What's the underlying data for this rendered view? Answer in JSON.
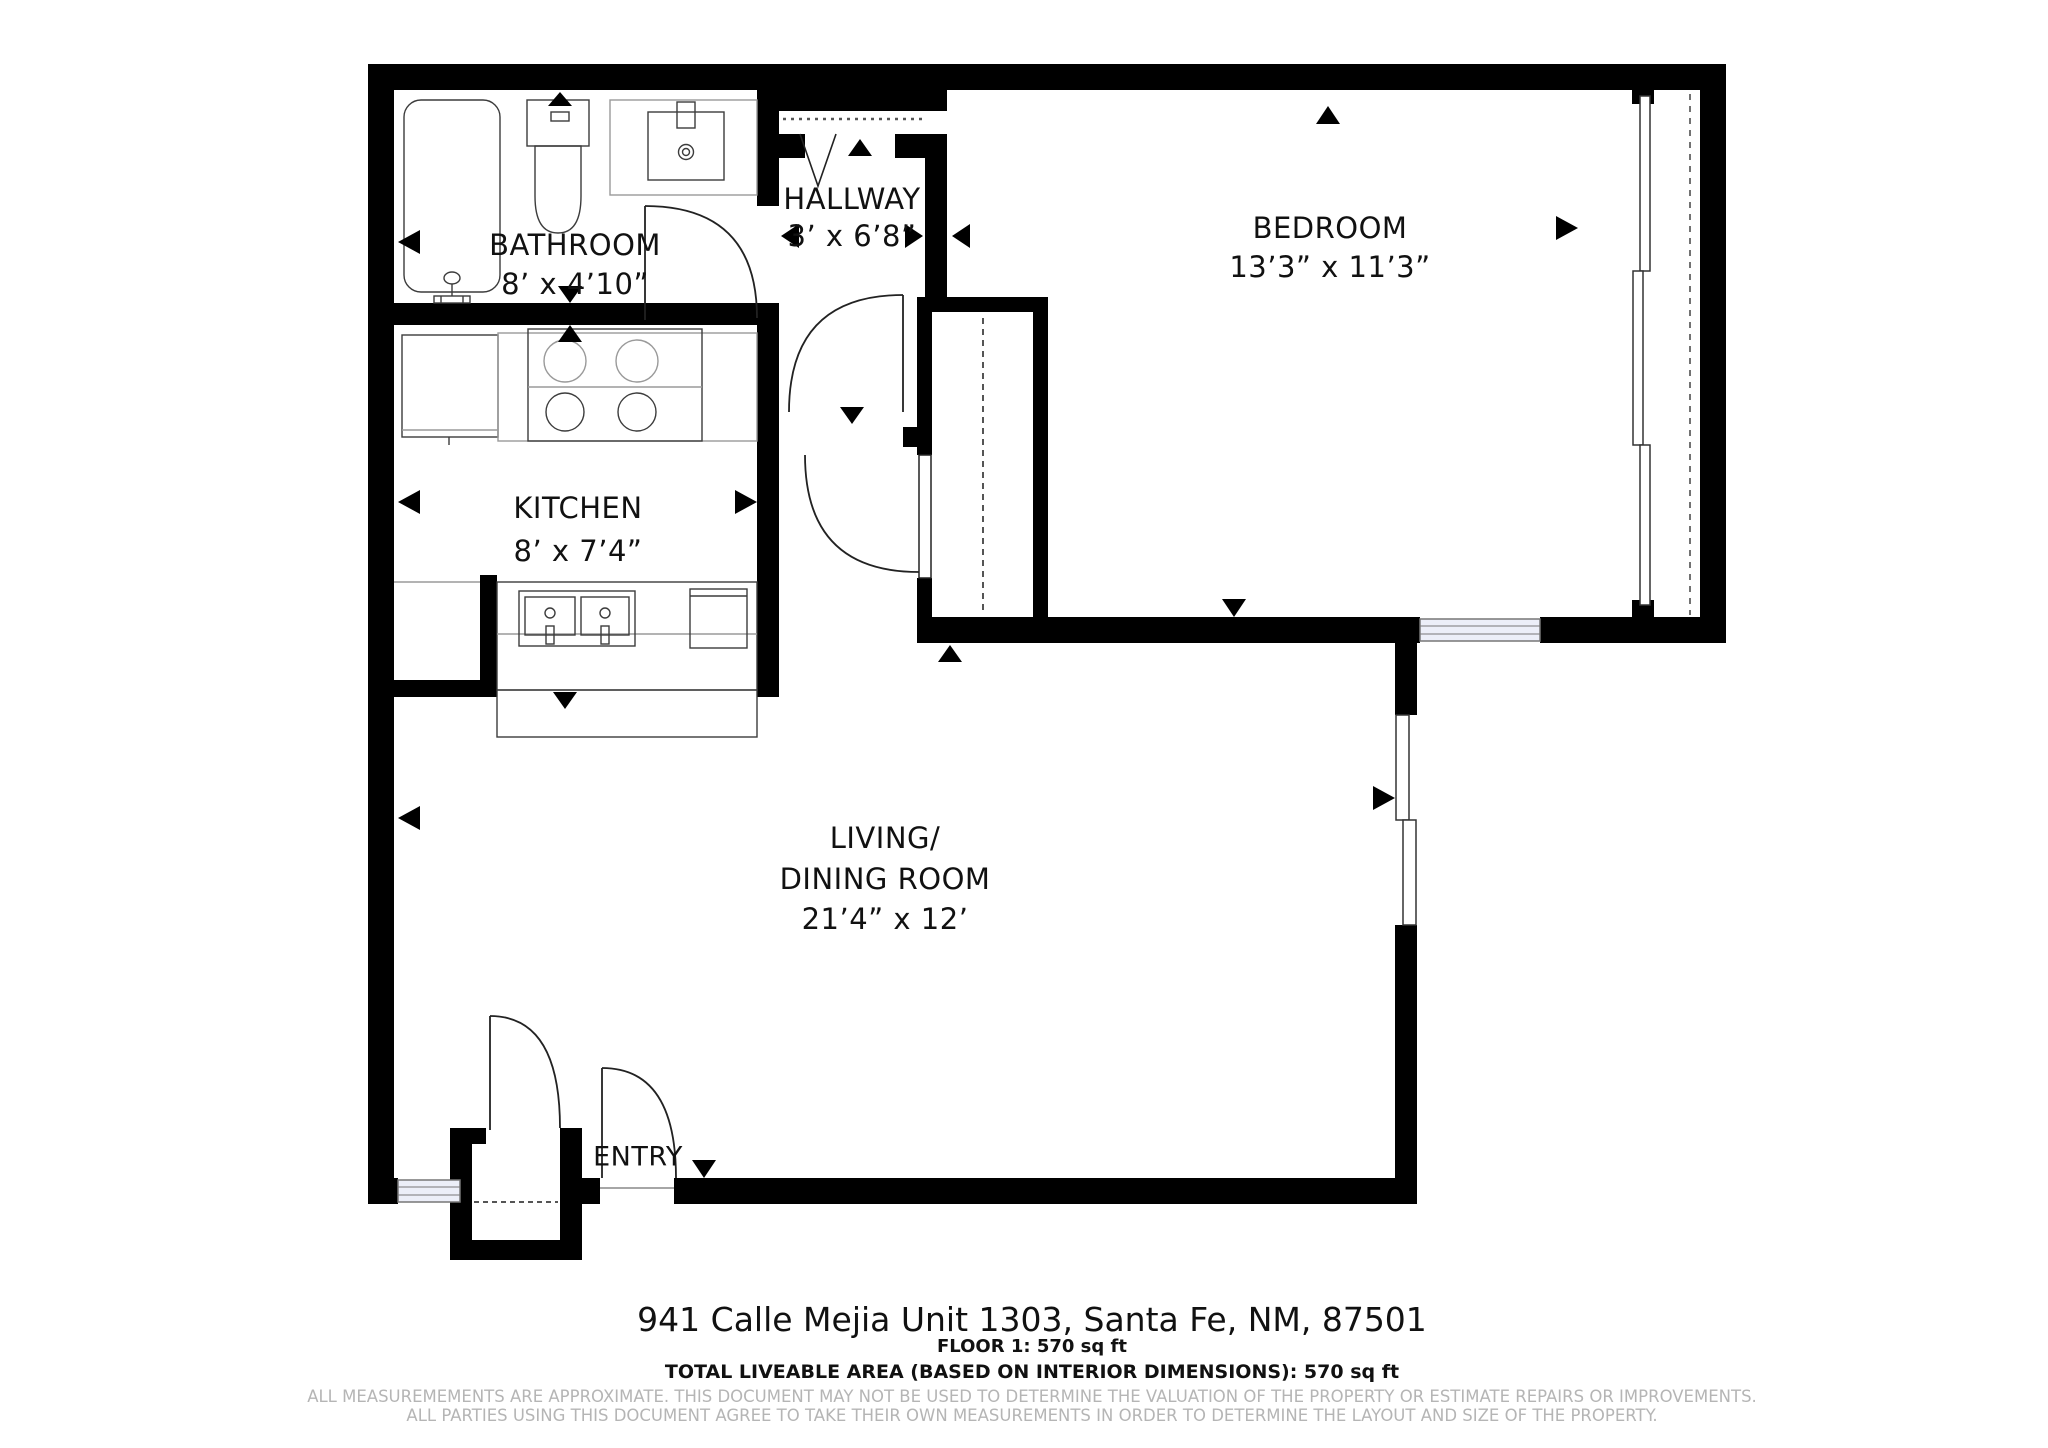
{
  "plan": {
    "rooms": {
      "bathroom": {
        "name": "BATHROOM",
        "dims": "8’ x 4’10”"
      },
      "hallway": {
        "name": "HALLWAY",
        "dims": "3’ x 6’8”"
      },
      "bedroom": {
        "name": "BEDROOM",
        "dims": "13’3” x 11’3”"
      },
      "kitchen": {
        "name": "KITCHEN",
        "dims": "8’ x 7’4”"
      },
      "living": {
        "line1": "LIVING/",
        "line2": "DINING ROOM",
        "dims": "21’4” x 12’"
      },
      "entry": {
        "name": "ENTRY"
      }
    },
    "fixtures": [
      "bathtub",
      "toilet",
      "vanity-sink",
      "refrigerator",
      "stove-4-burner",
      "double-kitchen-sink",
      "dishwasher",
      "counter-bar"
    ],
    "colors": {
      "wall": "#000000",
      "window_fill": "#eceef8",
      "fixture_stroke": "#3c3c3c",
      "light_stroke": "#9a9a9a",
      "dash": "#555555",
      "disclaimer_text": "#b5b5b5"
    }
  },
  "footer": {
    "address": "941 Calle Mejia Unit 1303, Santa Fe, NM, 87501",
    "floor_area": "FLOOR 1: 570 sq ft",
    "total_area": "TOTAL LIVEABLE AREA (BASED ON INTERIOR DIMENSIONS): 570 sq ft",
    "disclaimer_line1": "ALL MEASUREMEMENTS ARE APPROXIMATE. THIS DOCUMENT MAY NOT BE USED TO DETERMINE THE VALUATION OF THE PROPERTY OR ESTIMATE REPAIRS OR IMPROVEMENTS.",
    "disclaimer_line2": "ALL PARTIES USING THIS DOCUMENT AGREE TO TAKE THEIR OWN MEASUREMENTS IN ORDER TO DETERMINE THE LAYOUT AND SIZE OF THE PROPERTY."
  }
}
